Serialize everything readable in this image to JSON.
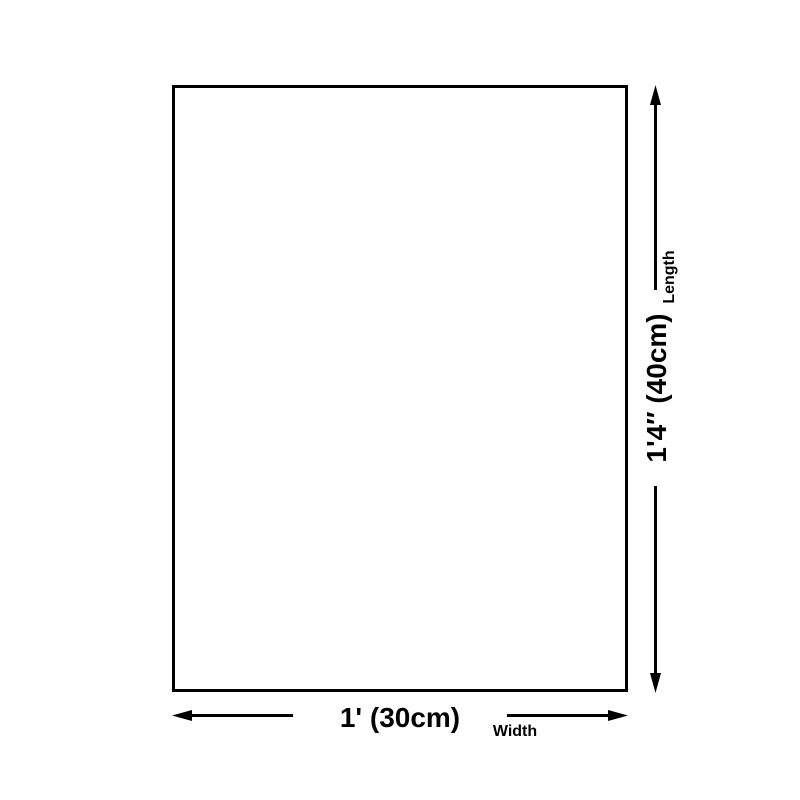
{
  "diagram": {
    "type": "product-dimension-diagram",
    "colors": {
      "line": "#000000",
      "background": "#ffffff",
      "rectangle_fill": "#ffffff"
    },
    "width": {
      "value": "1' (30cm)",
      "label": "Width"
    },
    "length": {
      "value": "1'4″ (40cm)",
      "label": "Length"
    }
  }
}
